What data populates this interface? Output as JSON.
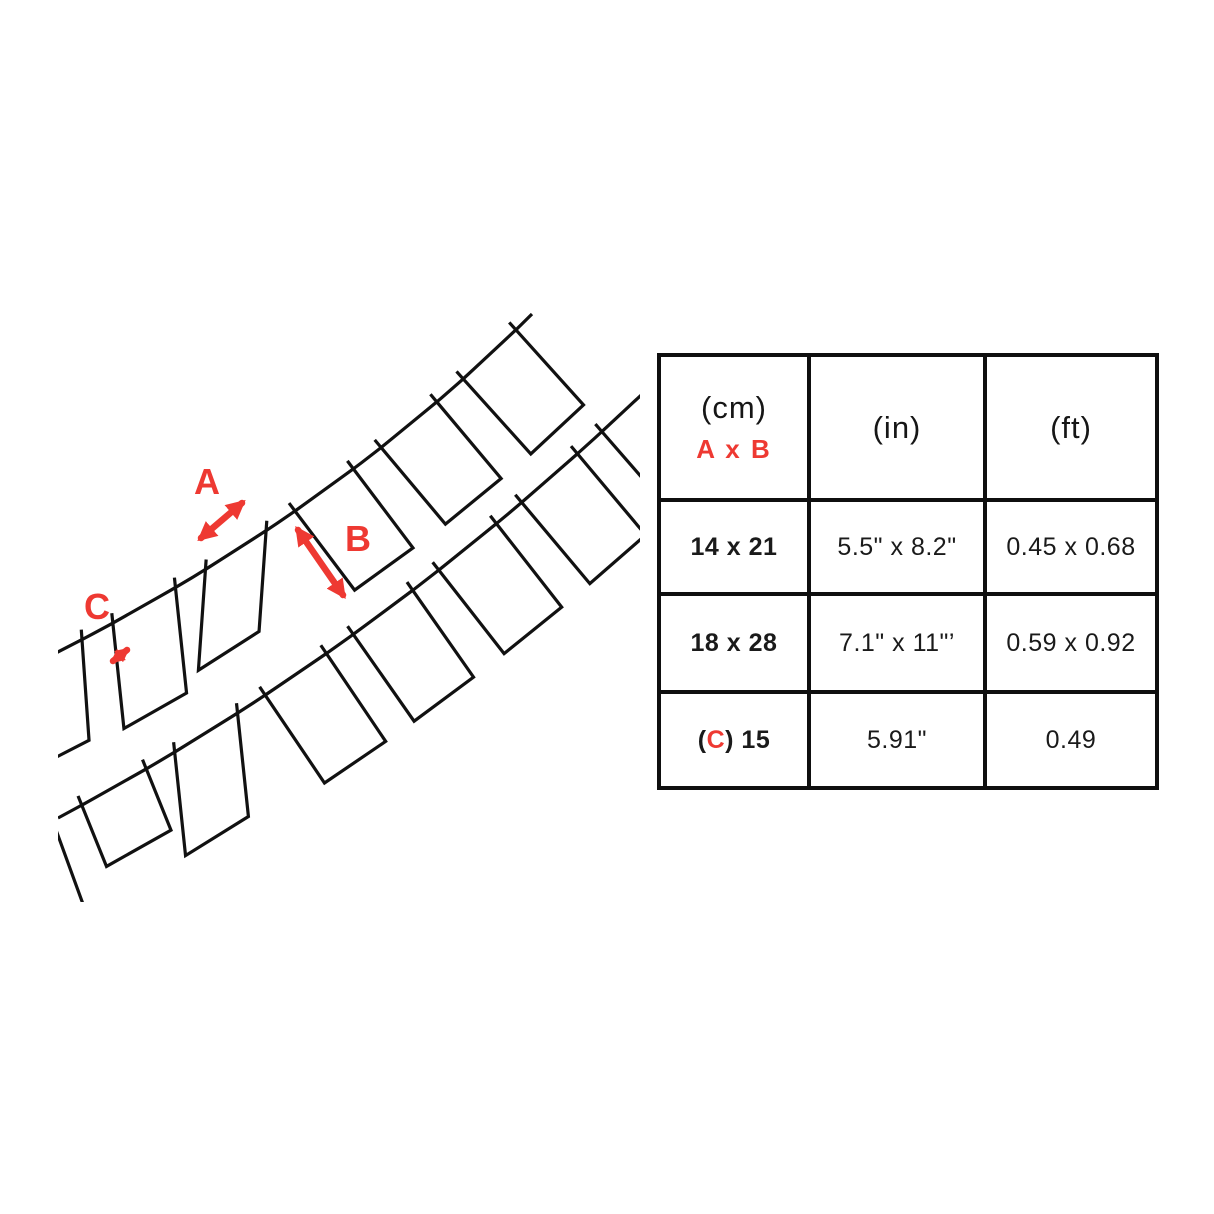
{
  "diagram": {
    "label_a": "A",
    "label_b": "B",
    "label_c": "C",
    "accent": "#ee3932",
    "line_color": "#111111"
  },
  "table": {
    "header": {
      "cm_unit": "(cm)",
      "cm_sub": "A x B",
      "in_unit": "(in)",
      "ft_unit": "(ft)"
    },
    "rows": [
      {
        "cm": "14 x 21",
        "inch": "5.5\" x 8.2\"",
        "ft": "0.45 x 0.68"
      },
      {
        "cm": "18 x 28",
        "inch": "7.1\" x 11\"’",
        "ft": "0.59 x 0.92"
      },
      {
        "cm_open": "(",
        "cm_c": "C",
        "cm_close": ") 15",
        "inch": "5.91\"",
        "ft": "0.49"
      }
    ]
  }
}
